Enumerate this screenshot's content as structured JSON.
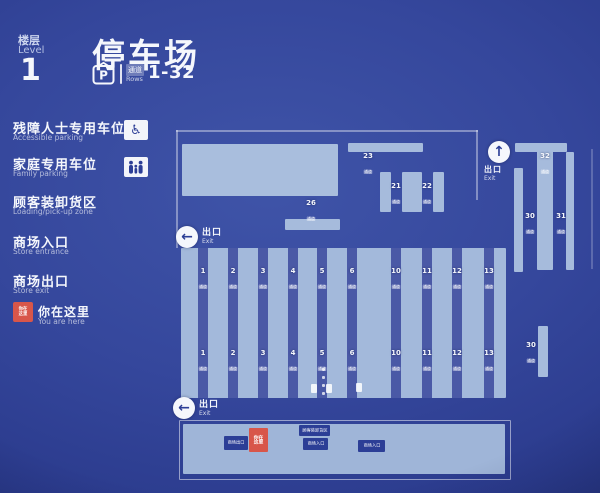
{
  "header": {
    "floor_zh": "楼层",
    "floor_en": "Level",
    "floor_number": "1",
    "title": "停车场",
    "parking_symbol": "P",
    "rows_zh": "通道",
    "rows_en": "Rows",
    "rows_range": "1-32"
  },
  "legend": {
    "items": [
      {
        "zh": "残障人士专用车位",
        "en": "Accessible parking",
        "icon": "wheelchair"
      },
      {
        "zh": "家庭专用车位",
        "en": "Family parking",
        "icon": "family"
      },
      {
        "zh": "顾客装卸货区",
        "en": "Loading/pick-up zone",
        "icon": ""
      },
      {
        "zh": "商场入口",
        "en": "Store entrance",
        "icon": ""
      },
      {
        "zh": "商场出口",
        "en": "Store exit",
        "icon": ""
      }
    ],
    "you_are_here": {
      "zh": "你在这里",
      "en": "You are here",
      "marker_text": "你在这里",
      "marker_color": "#d8564a"
    }
  },
  "map": {
    "aisle_word": "通道",
    "exit": {
      "zh": "出口",
      "en": "Exit"
    },
    "grid_top": [
      "1",
      "2",
      "3",
      "4",
      "5",
      "6",
      "10",
      "11",
      "12",
      "13"
    ],
    "grid_bottom": [
      "1",
      "2",
      "3",
      "4",
      "5",
      "6",
      "10",
      "11",
      "12",
      "13"
    ],
    "upper": {
      "a23": "23",
      "a21": "21",
      "a22": "22",
      "a26": "26"
    },
    "right": {
      "a32": "32",
      "a30": "30",
      "a31": "31",
      "a30b": "30"
    },
    "mall_boxes": [
      {
        "label": "商场出口",
        "type": "dark"
      },
      {
        "label": "你在这里",
        "type": "red"
      },
      {
        "label": "顾客装卸货区",
        "type": "dark"
      },
      {
        "label": "商场入口",
        "type": "dark"
      },
      {
        "label": "商场入口",
        "type": "dark"
      }
    ]
  },
  "colors": {
    "background": "#33459a",
    "panel_light": "#a6bbdc",
    "marker_red": "#d8564a",
    "box_dark": "#2c3e96"
  }
}
